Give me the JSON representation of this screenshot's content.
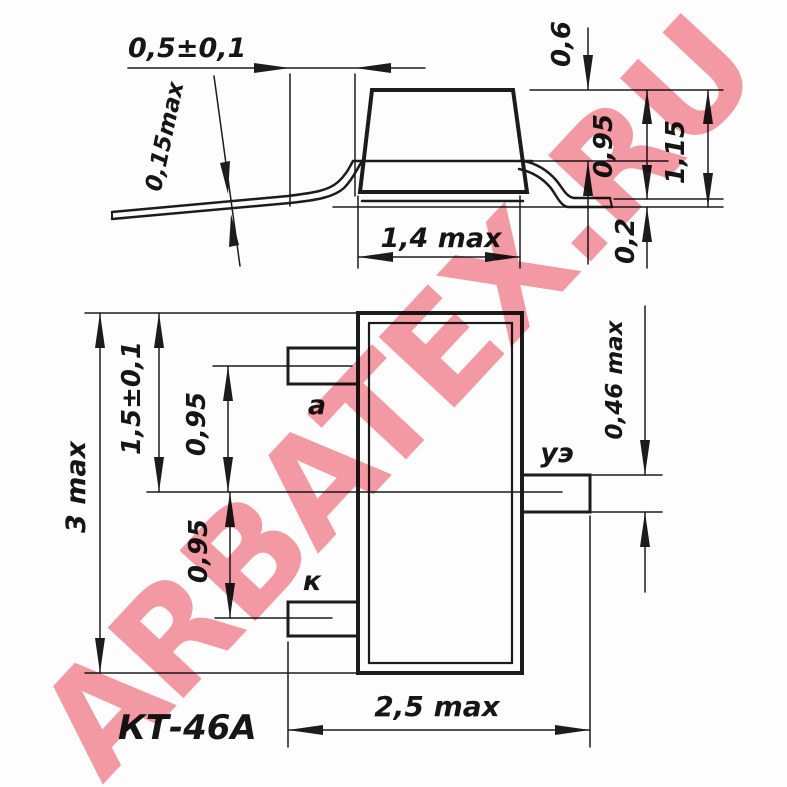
{
  "package_name": "КТ-46А",
  "watermark": {
    "text": "ARBATEX.RU",
    "color": "#f59aa5"
  },
  "colors": {
    "line": "#1c1c1c",
    "background": "#fdfdfd"
  },
  "side_view": {
    "lead_protrusion": "0,5±0,1",
    "lead_thickness": "0,15max",
    "top_to_lead": "0,6",
    "top_to_foot": "0,95",
    "foot_thickness": "0,2",
    "total_height": "1,15",
    "body_width": "1,4 max"
  },
  "plan_view": {
    "body_length": "3 max",
    "edge_to_gate": "1,5±0,1",
    "pitch_upper": "0,95",
    "pitch_lower": "0,95",
    "lead_width": "0,46 max",
    "total_width": "2,5 max",
    "lead_anode": "а",
    "lead_gate": "уэ",
    "lead_cathode": "к"
  }
}
